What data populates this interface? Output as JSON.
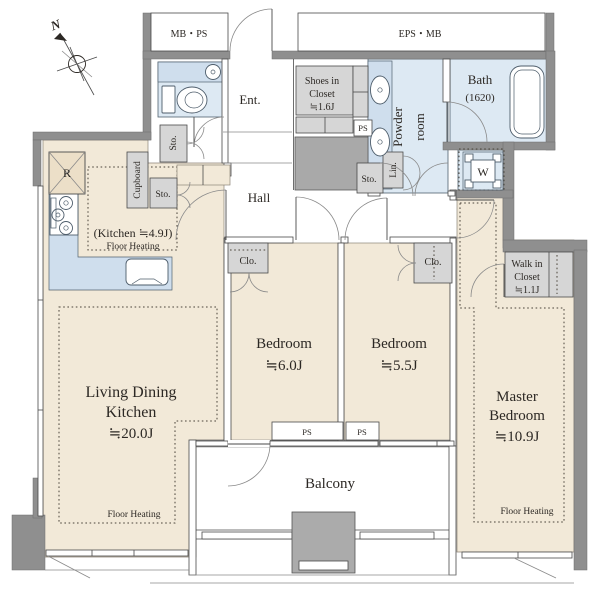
{
  "compass": {
    "north_label": "N"
  },
  "service_areas": {
    "mb_ps": "MB・PS",
    "eps_mb": "EPS・MB",
    "ps_shoes": "PS",
    "ps_balcony_1": "PS",
    "ps_balcony_2": "PS"
  },
  "entrance": {
    "label": "Ent.",
    "hall_label": "Hall",
    "shoes_closet": [
      "Shoes in",
      "Closet",
      "≒1.6J"
    ],
    "storage_toilet": "Sto.",
    "storage_hall": "Sto."
  },
  "sanitary": {
    "powder_room": [
      "Powder",
      "room"
    ],
    "bath": [
      "Bath",
      "(1620)"
    ],
    "washer": "W",
    "linen": "Lin.",
    "storage_powder": "Sto."
  },
  "kitchen": {
    "label": "(Kitchen ≒4.9J)",
    "floor_heating": "Floor Heating",
    "refrigerator": "R",
    "cupboard": "Cupboard"
  },
  "ldk": {
    "name_line1": "Living Dining",
    "name_line2": "Kitchen",
    "area": "≒20.0J",
    "floor_heating": "Floor Heating"
  },
  "bedroom1": {
    "name": "Bedroom",
    "area": "≒6.0J",
    "closet": "Clo."
  },
  "bedroom2": {
    "name": "Bedroom",
    "area": "≒5.5J",
    "closet": "Clo."
  },
  "master": {
    "name_line1": "Master",
    "name_line2": "Bedroom",
    "area": "≒10.9J",
    "floor_heating": "Floor Heating",
    "walk_in_closet": [
      "Walk in",
      "Closet",
      "≒1.1J"
    ]
  },
  "balcony": {
    "label": "Balcony"
  },
  "colors": {
    "wall_gray": "#8f8f8f",
    "room_beige": "#f2e9d8",
    "wet_blue": "#dde9f3",
    "storage_gray": "#d6d6d6",
    "shaft_gray": "#a9a9a9"
  }
}
